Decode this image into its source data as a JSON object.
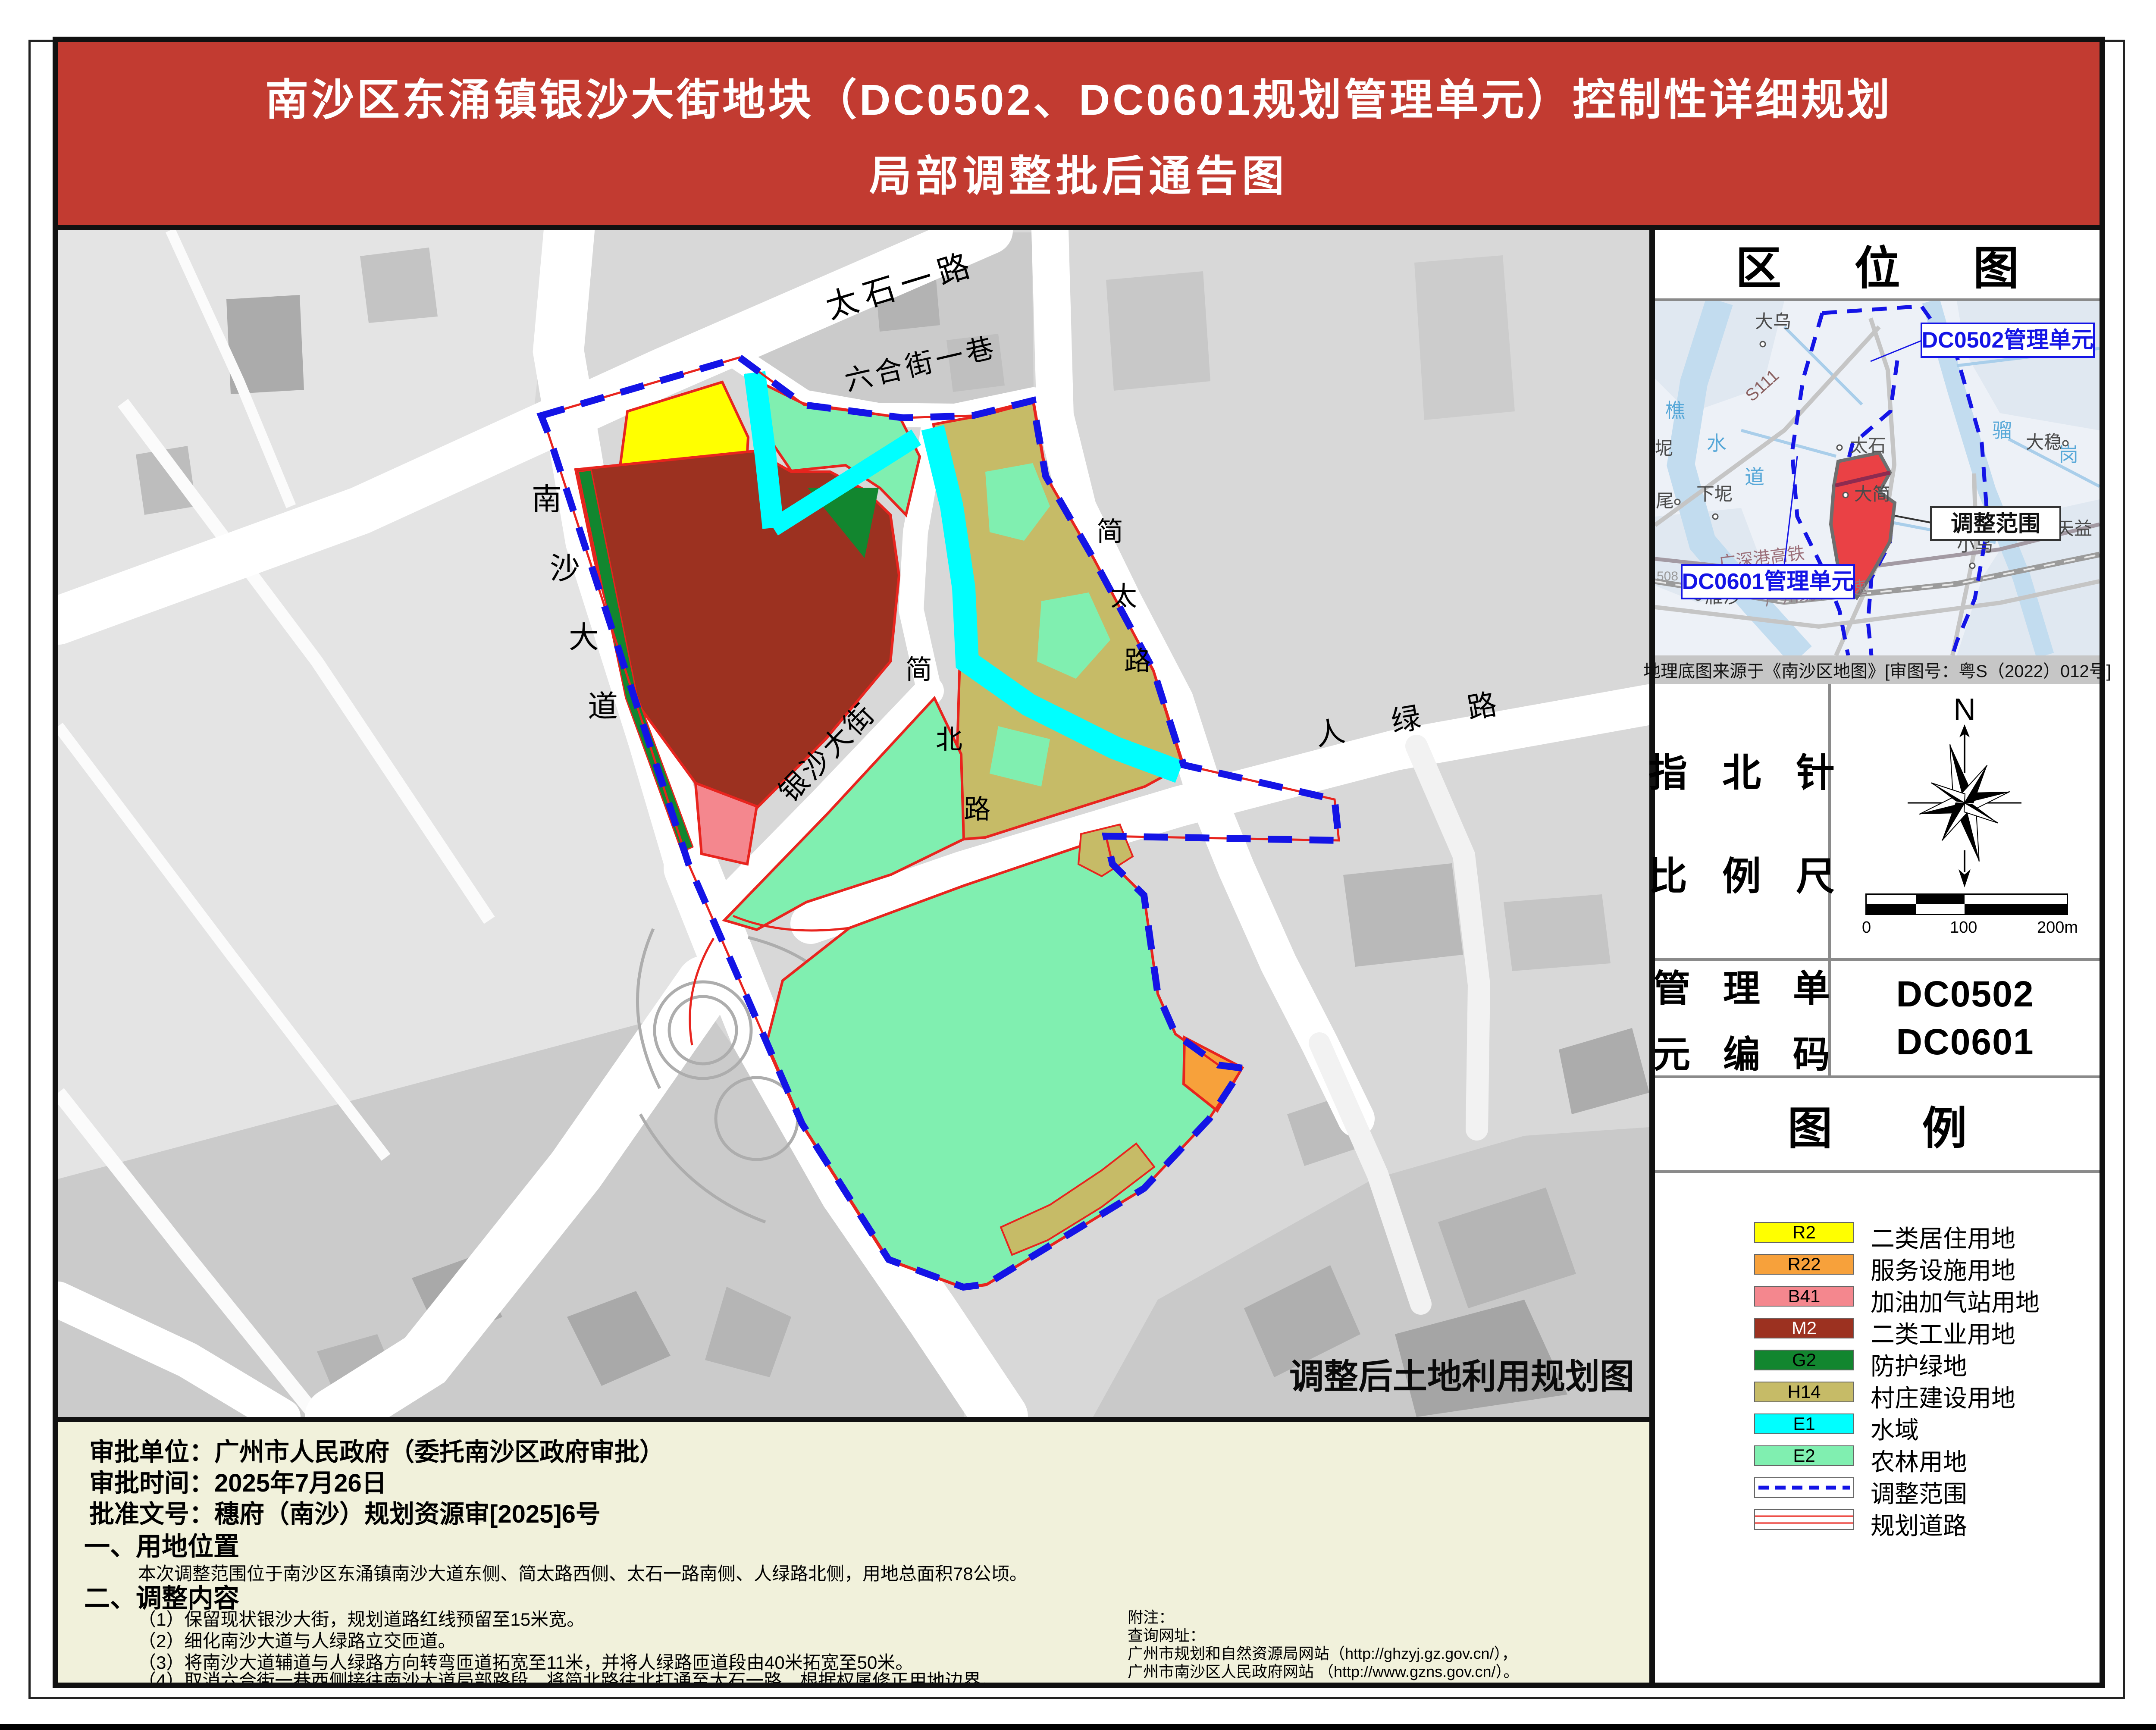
{
  "palette": {
    "banner": "#C23B31",
    "panel": "#F1F1DB",
    "R2": "#FFFF00",
    "R22": "#F7A13B",
    "B41": "#F4878E",
    "M2": "#9C3120",
    "G2": "#12862F",
    "H14": "#C6BB67",
    "E1": "#00FFFF",
    "E2": "#80EFB0",
    "boundary": "#1414E6",
    "plan_road": "#E8241E",
    "loc_scope": "#EA4145"
  },
  "title": {
    "line1": "南沙区东涌镇银沙大街地块（DC0502、DC0601规划管理单元）控制性详细规划",
    "line2": "局部调整批后通告图"
  },
  "map": {
    "caption": "调整后土地利用规划图",
    "labels": {
      "taishi_rd": "太石一路",
      "liuhe_lane": "六合街一巷",
      "nansha_1": "南",
      "nansha_2": "沙",
      "nansha_3": "大",
      "nansha_4": "道",
      "jiantai_1": "简",
      "jiantai_2": "太",
      "jiantai_3": "路",
      "jianbei_1": "简",
      "jianbei_2": "北",
      "jianbei_3": "路",
      "yinsha_st": "银沙大街",
      "renlv_rd": "人 绿 路"
    }
  },
  "sidebar": {
    "location": {
      "title": "区  位  图",
      "callout_dc0502": "DC0502管理单元",
      "callout_scope": "调整范围",
      "callout_dc0601": "DC0601管理单元",
      "caption": "地理底图来源于《南沙区地图》[审图号：粤S（2022）012号]",
      "places": {
        "dawu": "大乌",
        "dawen": "大稳",
        "xiani": "下坭",
        "dajian": "大简",
        "tianyi": "天益",
        "xiaowu": "小乌",
        "yansha": "雁沙",
        "taishi": "太石",
        "wei": "尾",
        "ni": "坭",
        "qiao": "樵",
        "shui": "水",
        "dao": "道",
        "liu": "骝",
        "gang": "岗",
        "s111": "S111",
        "g508": "508",
        "rail": "广深港高铁",
        "hwy": "广州绕城高速"
      }
    },
    "compass": {
      "row1": "指 北 针",
      "row2": "比 例 尺",
      "north": "N",
      "tick0": "0",
      "tick100": "100",
      "tick200": "200m"
    },
    "unit": {
      "row1": "管 理 单",
      "row2": "元 编 码",
      "code1": "DC0502",
      "code2": "DC0601"
    },
    "legend": {
      "title": "图　　例",
      "items": [
        {
          "code": "R2",
          "label": "二类居住用地"
        },
        {
          "code": "R22",
          "label": "服务设施用地"
        },
        {
          "code": "B41",
          "label": "加油加气站用地"
        },
        {
          "code": "M2",
          "label": "二类工业用地"
        },
        {
          "code": "G2",
          "label": "防护绿地"
        },
        {
          "code": "H14",
          "label": "村庄建设用地"
        },
        {
          "code": "E1",
          "label": "水域"
        },
        {
          "code": "E2",
          "label": "农林用地"
        },
        {
          "code": "",
          "label": "调整范围"
        },
        {
          "code": "",
          "label": "规划道路"
        }
      ]
    }
  },
  "footer": {
    "approval_unit": "审批单位：广州市人民政府（委托南沙区政府审批）",
    "approval_time": "审批时间：2025年7月26日",
    "approval_doc": "批准文号：穗府（南沙）规划资源审[2025]6号",
    "sec1_title": "一、用地位置",
    "sec1_body": "本次调整范围位于南沙区东涌镇南沙大道东侧、简太路西侧、太石一路南侧、人绿路北侧，用地总面积78公顷。",
    "sec2_title": "二、调整内容",
    "item1": "（1）保留现状银沙大街，规划道路红线预留至15米宽。",
    "item2": "（2）细化南沙大道与人绿路立交匝道。",
    "item3": "（3）将南沙大道辅道与人绿路方向转弯匝道拓宽至11米，并将人绿路匝道段由40米拓宽至50米。",
    "item4": "（4）取消六合街一巷西侧接往南沙大道局部路段，将简北路往北打通至太石一路，根据权属修正用地边界。",
    "note1": "附注：",
    "note2": "查询网址：",
    "note3": "广州市规划和自然资源局网站（http://ghzyj.gz.gov.cn/），",
    "note4": "广州市南沙区人民政府网站 （http://www.gzns.gov.cn/）。"
  }
}
